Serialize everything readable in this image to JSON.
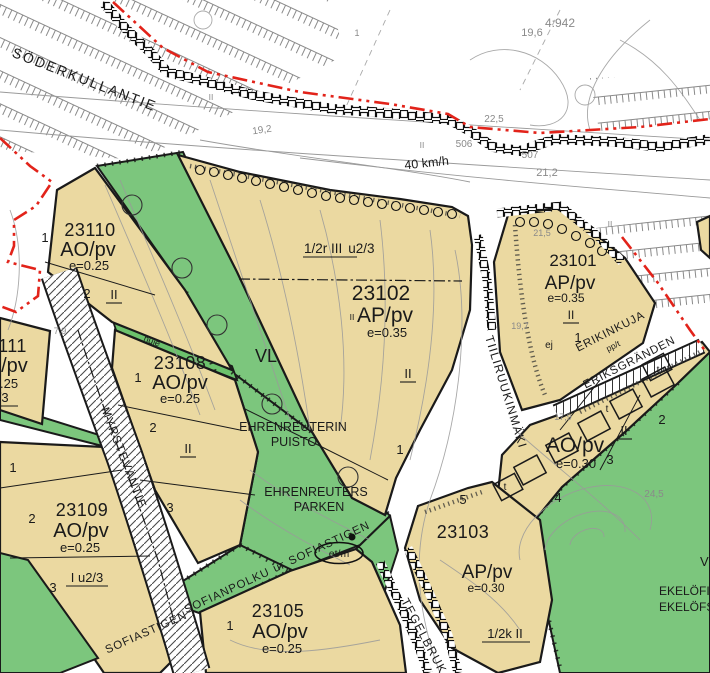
{
  "zones": {
    "z23110": {
      "id": "23110",
      "code": "AO/pv",
      "e": "e=0.25",
      "storeys": "II",
      "plots": [
        "1",
        "2"
      ]
    },
    "z23111": {
      "id": "23111",
      "code": "AO/pv",
      "e": "e=0.25",
      "u": "u2/3"
    },
    "z23108": {
      "id": "23108",
      "code": "AO/pv",
      "e": "e=0.25",
      "storeys": "II",
      "plots": [
        "1",
        "2",
        "3"
      ]
    },
    "z23109": {
      "id": "23109",
      "code": "AO/pv",
      "e": "e=0.25",
      "u": "I u2/3",
      "plots": [
        "1",
        "2",
        "3"
      ]
    },
    "z23105": {
      "id": "23105",
      "code": "AO/pv",
      "e": "e=0.25",
      "plots": [
        "1"
      ]
    },
    "z23102": {
      "id": "23102",
      "code": "AP/pv",
      "e": "e=0.35",
      "top": "1/2r III",
      "top2": "u2/3",
      "storeys": "II",
      "storeys_small": "II",
      "plots": [
        "1"
      ]
    },
    "z23101": {
      "id": "23101",
      "code": "AP/pv",
      "e": "e=0.35",
      "storeys": "II",
      "plots": [
        "1"
      ],
      "ej": "ej"
    },
    "zAOe030": {
      "code": "AO/pv",
      "e": "e=0.30",
      "storeys": "II",
      "plots": [
        "2",
        "3",
        "4"
      ],
      "t": "t"
    },
    "z23103": {
      "id": "23103",
      "code": "AP/pv",
      "e": "e=0.30",
      "storeys": "1/2k II",
      "plots": [
        "5"
      ]
    }
  },
  "parks": {
    "vl": "VL",
    "hule": "hule",
    "puisto_fi_1": "EHRENREUTERIN",
    "puisto_fi_2": "PUISTO",
    "puisto_sv_1": "EHRENREUTERS",
    "puisto_sv_2": "PARKEN",
    "ekelof_fi": "EKELÖFI",
    "ekelof_sv": "EKELÖFS",
    "v": "V"
  },
  "streets": {
    "soderkullantie": "SÖDERKULLANTIE",
    "speed": "40 km/h",
    "tiiliruukinmaki": "TIILIRUUKINMÄKI",
    "myrstevantie": "MYRSTEVÄNTIE",
    "sofianpolku": "SOFIANPOLKU",
    "route_marker": "ur",
    "sofiastigen": "SOFIASTIGEN",
    "sofiastigen_sw": "SOFIASTIGEN",
    "tegelbruk": "TEGELBRUK",
    "erikinkuja": "ERIKINKUJA",
    "eriksgranden": "ERIKSGRÄNDEN",
    "path_code": "pp/t",
    "etm": "et/m"
  },
  "measurements": {
    "m19_2": "19,2",
    "m22_5": "22,5",
    "m506": "506",
    "m507": "507",
    "m21_2": "21,2",
    "m19_6": "19,6",
    "m4_942": "4:942",
    "m1": "1",
    "m7_9": "7,9",
    "m21_5": "21,5",
    "m19_7": "19,7",
    "m17_9": "17,9",
    "m24_5": "24,5",
    "mII_a": "II",
    "mII_b": "II",
    "mII_c": "II"
  },
  "colors": {
    "residential": "#ebd9a1",
    "park": "#7cc67d",
    "boundary_red": "#e2231a",
    "contour": "#9a9a9a"
  }
}
